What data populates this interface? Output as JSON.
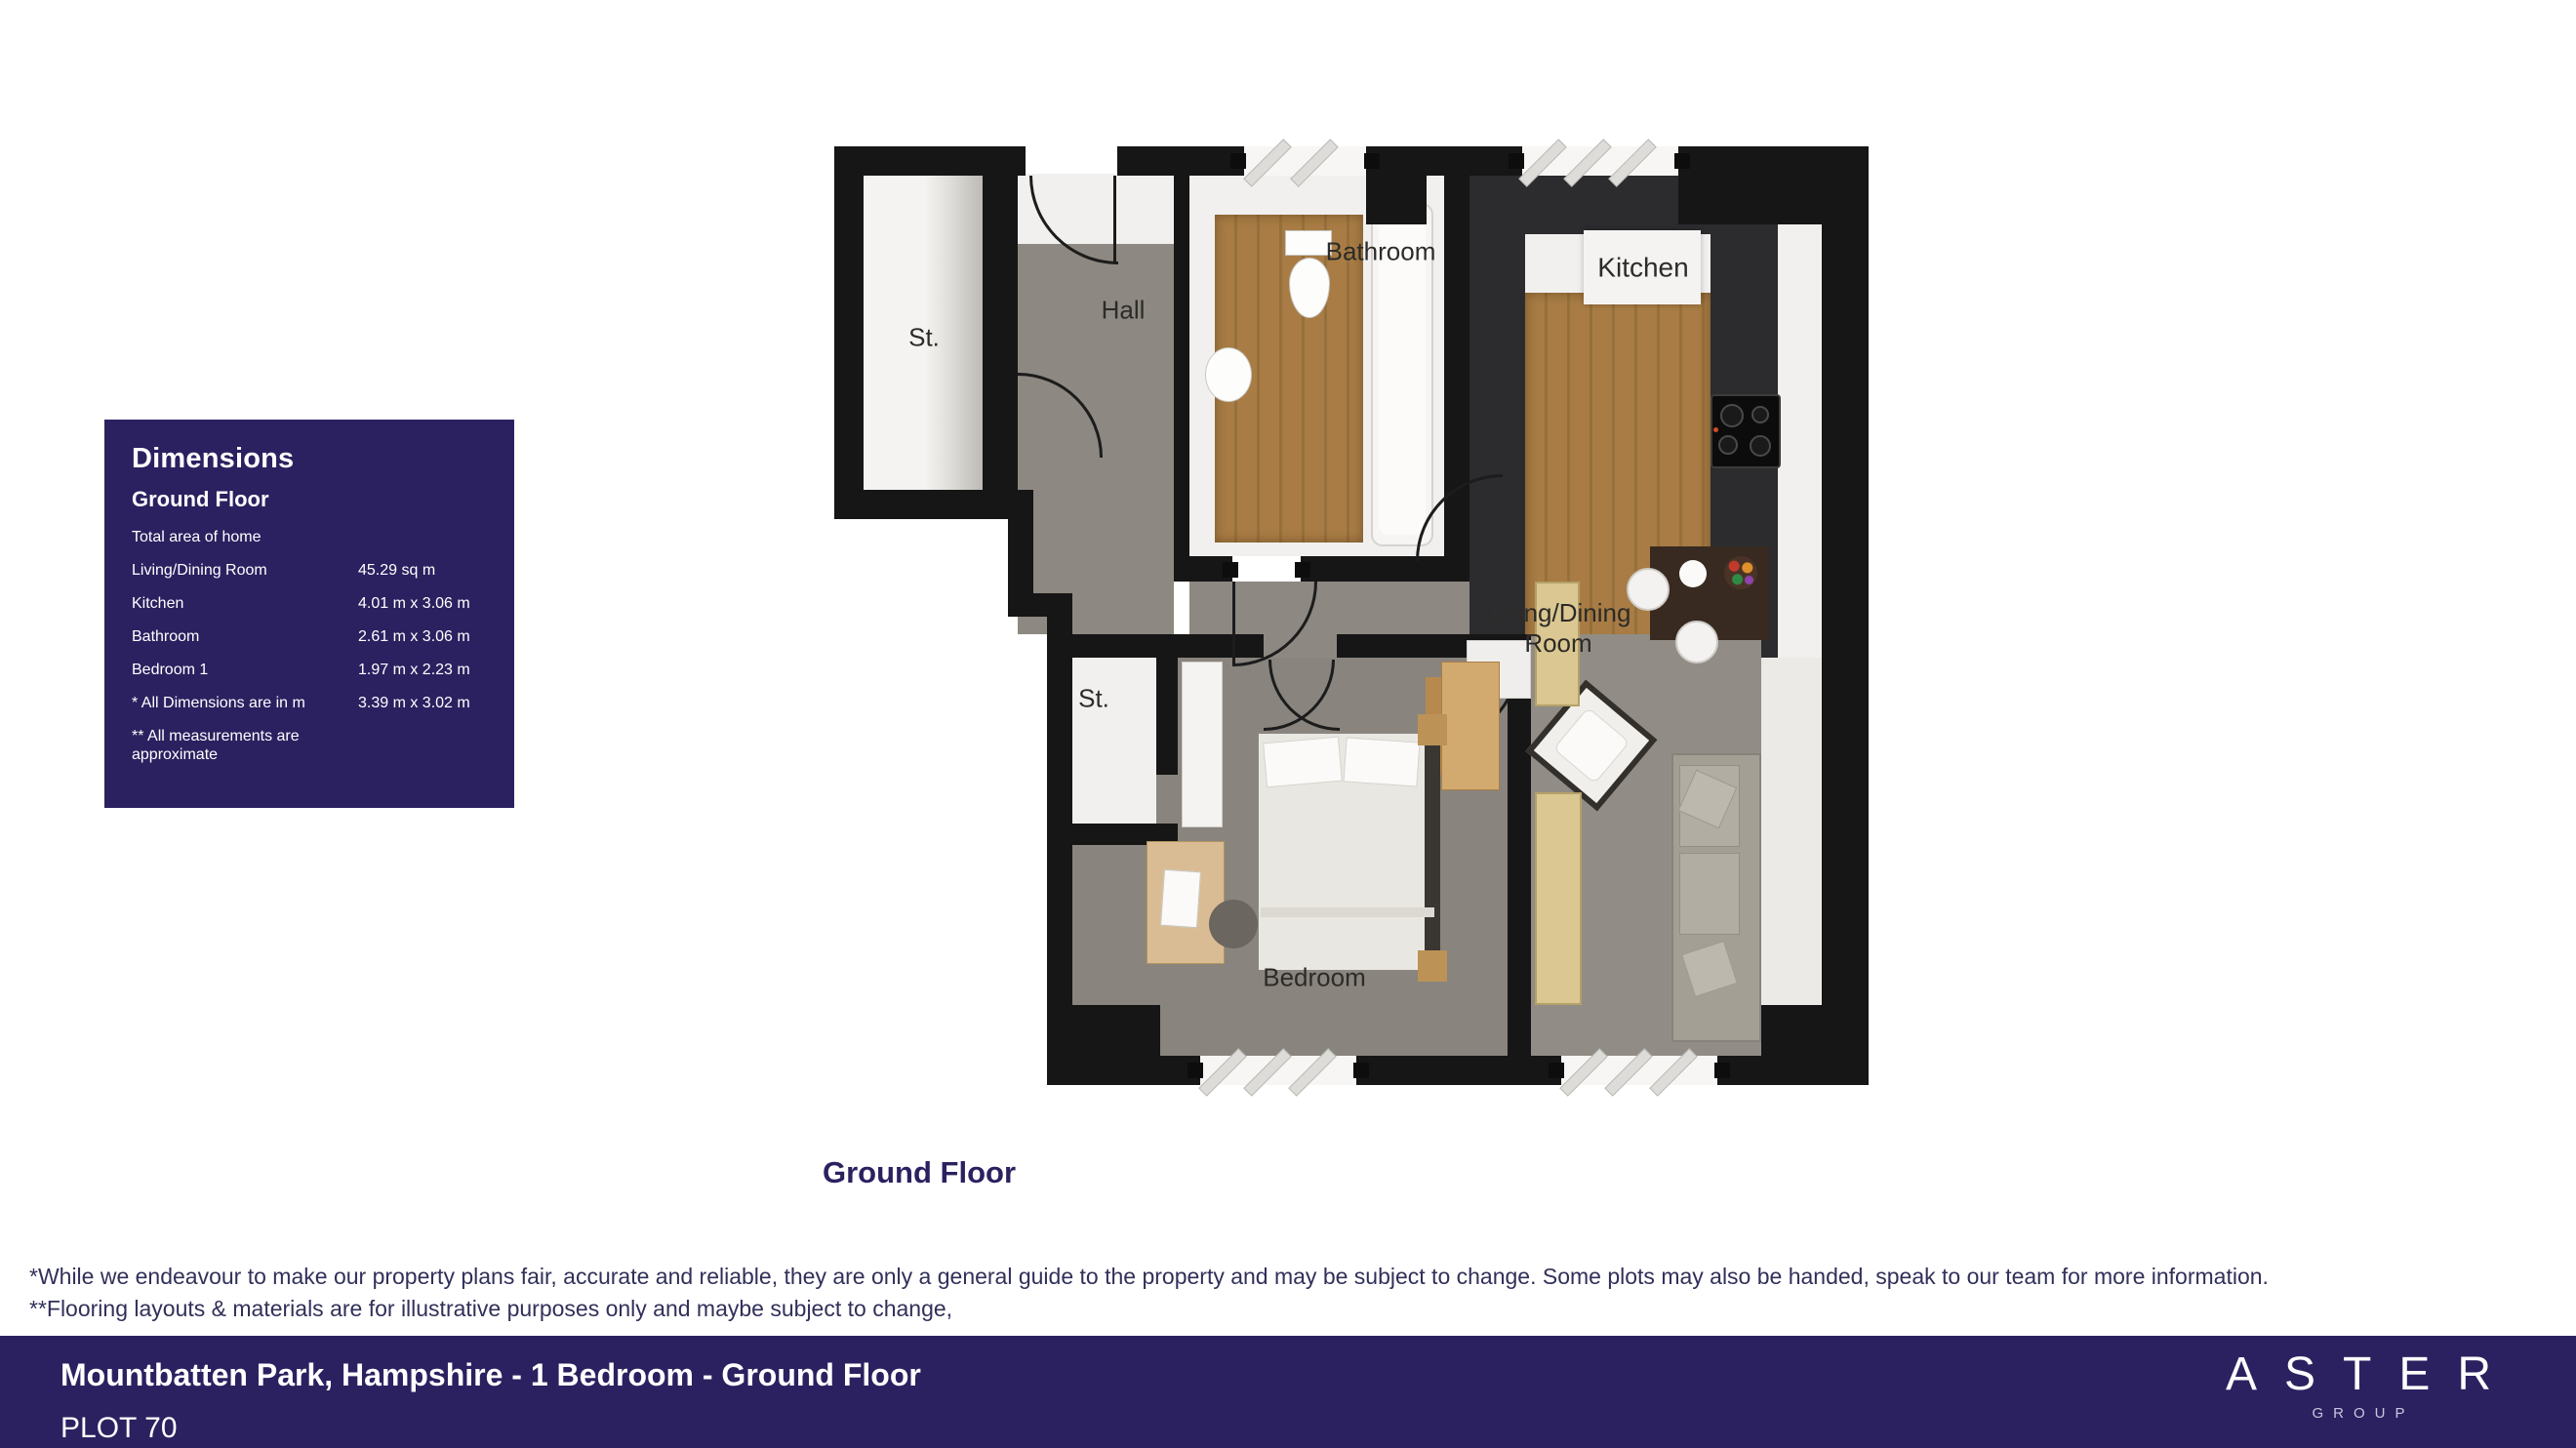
{
  "dimensions_panel": {
    "title": "Dimensions",
    "subtitle": "Ground Floor",
    "rows": [
      {
        "label": "Total area of home",
        "value": ""
      },
      {
        "label": "Living/Dining Room",
        "value": "45.29 sq m"
      },
      {
        "label": "Kitchen",
        "value": "4.01 m x 3.06 m"
      },
      {
        "label": "Bathroom",
        "value": "2.61 m x 3.06 m"
      },
      {
        "label": "Bedroom 1",
        "value": "1.97 m x 2.23 m"
      },
      {
        "label": "* All Dimensions are in m",
        "value": "3.39 m x 3.02 m"
      },
      {
        "label": "** All measurements are approximate",
        "value": ""
      }
    ]
  },
  "floor_plan": {
    "caption": "Ground Floor",
    "labels": {
      "storage_top": "St.",
      "hall": "Hall",
      "bathroom": "Bathroom",
      "kitchen": "Kitchen",
      "living_dining_line1": "Living/Dining",
      "living_dining_line2": "Room",
      "storage_bottom": "St.",
      "bedroom": "Bedroom"
    }
  },
  "disclaimer": {
    "line1": "*While we endeavour to make our property plans fair, accurate and reliable, they are only a general guide to the property and may be subject to change. Some plots may also be handed, speak to our team for more information.",
    "line2": "**Flooring layouts & materials are for illustrative purposes only and maybe subject to change,"
  },
  "footer": {
    "title": "Mountbatten Park, Hampshire - 1 Bedroom - Ground Floor",
    "plot": "PLOT 70",
    "brand_name": "ASTER",
    "brand_sub": "GROUP"
  },
  "colors": {
    "accent": "#2b2160",
    "wall": "#161616",
    "wood_floor": "#a87c44",
    "gray_floor": "#8d8881"
  }
}
